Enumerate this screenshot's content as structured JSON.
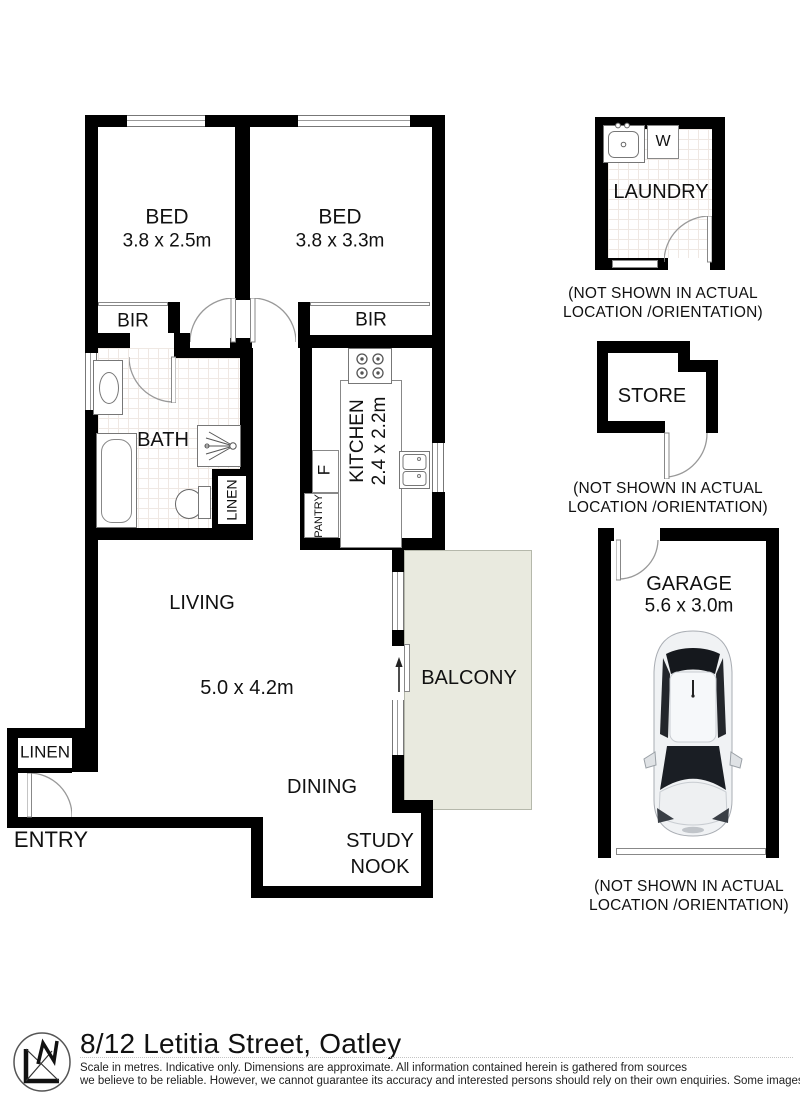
{
  "floorplan": {
    "rooms": {
      "bed1": {
        "label": "BED",
        "dims": "3.8 x 2.5m"
      },
      "bed2": {
        "label": "BED",
        "dims": "3.8 x 3.3m"
      },
      "bir1": {
        "label": "BIR"
      },
      "bir2": {
        "label": "BIR"
      },
      "bath": {
        "label": "BATH"
      },
      "bath_linen": {
        "label": "LINEN"
      },
      "kitchen": {
        "label": "KITCHEN",
        "dims": "2.4 x 2.2m"
      },
      "fridge": {
        "label": "F"
      },
      "pantry": {
        "label": "PANTRY"
      },
      "living": {
        "label": "LIVING",
        "dims": "5.0 x 4.2m"
      },
      "dining": {
        "label": "DINING"
      },
      "study_nook": {
        "label": "STUDY NOOK"
      },
      "balcony": {
        "label": "BALCONY"
      },
      "entry": {
        "label": "ENTRY"
      },
      "entry_linen": {
        "label": "LINEN"
      },
      "laundry": {
        "label": "LAUNDRY",
        "washer": "W"
      },
      "store": {
        "label": "STORE"
      },
      "garage": {
        "label": "GARAGE",
        "dims": "5.6 x 3.0m"
      }
    },
    "notes": {
      "laundry": "(NOT SHOWN IN ACTUAL LOCATION /ORIENTATION)",
      "store": "(NOT SHOWN IN ACTUAL LOCATION /ORIENTATION)",
      "garage": "(NOT SHOWN IN ACTUAL LOCATION /ORIENTATION)"
    }
  },
  "footer": {
    "address": "8/12 Letitia Street, Oatley",
    "disclaimer_line1": "Scale in metres. Indicative only. Dimensions are approximate. All information contained herein is gathered from sources",
    "disclaimer_line2": "we believe to be reliable. However, we cannot guarantee its accuracy and interested persons should rely on their own enquiries. Some images may contain digital furniture."
  },
  "colors": {
    "wall": "#000000",
    "balcony_fill": "#e9eadf",
    "arc_line": "#999999"
  }
}
